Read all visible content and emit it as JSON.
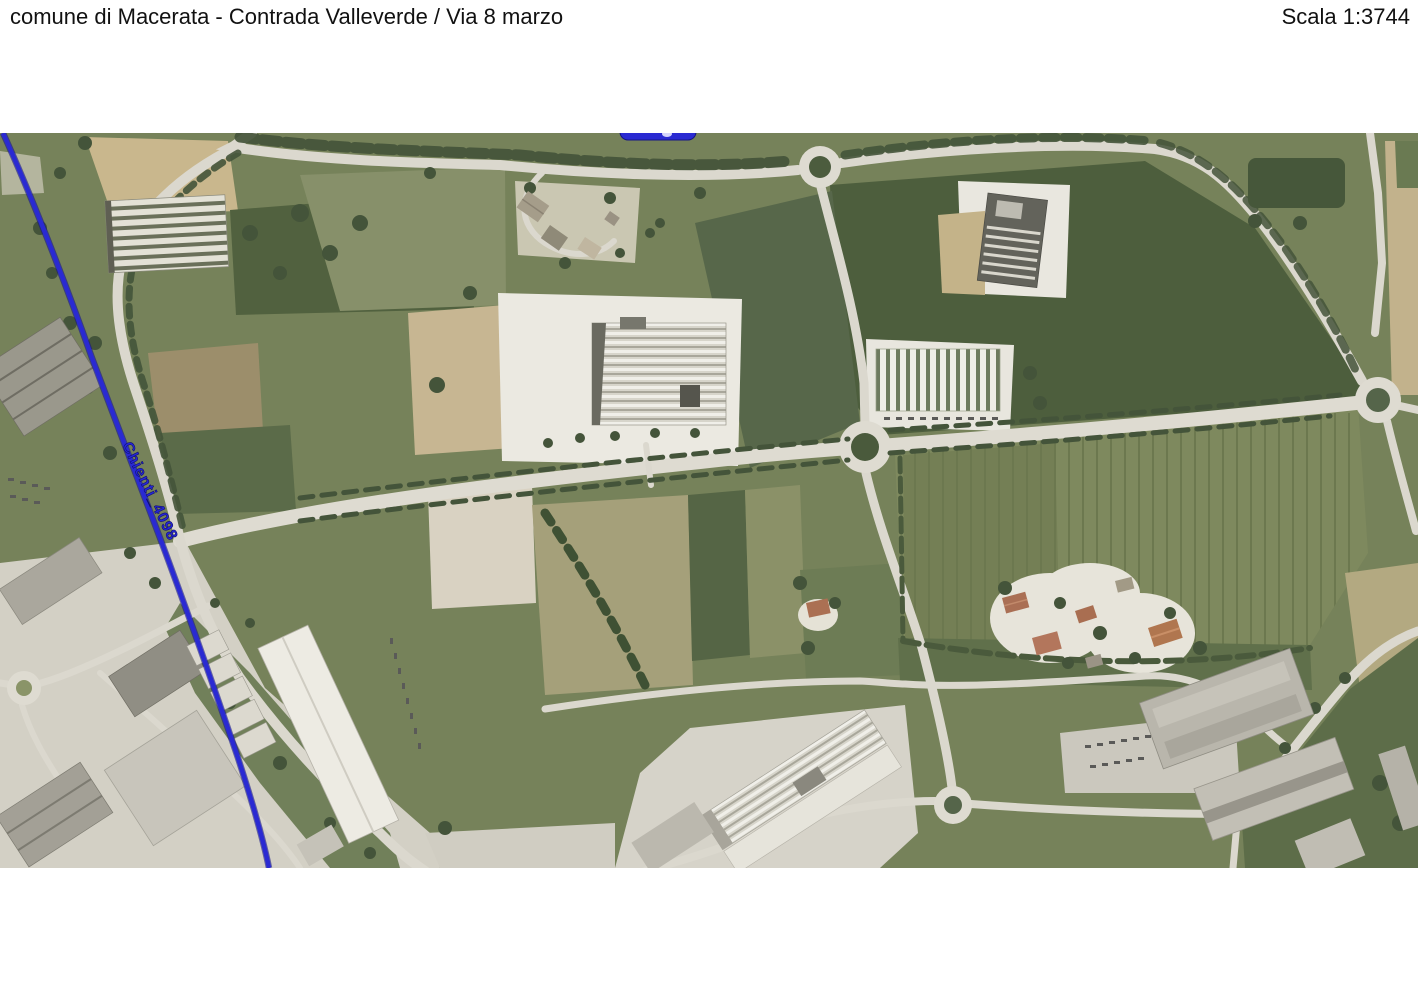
{
  "page": {
    "background": "#ffffff"
  },
  "header": {
    "title": "comune di Macerata - Contrada Valleverde / Via 8 marzo",
    "scale_label": "Scala 1:3744"
  },
  "map": {
    "kind": "aerial-orthophoto",
    "route_overlay": {
      "label": "Chienti_4098",
      "color": "#2a2ad2",
      "casing_color": "#151585"
    },
    "features": {
      "roundabouts": 5
    },
    "palette": {
      "road": "#dbd8ce",
      "field_base_green": "#76825a",
      "field_dark_green": "#4d5e3d",
      "field_olive": "#a5a07a",
      "field_tan": "#c7b692",
      "gravel_white": "#ebe9e1",
      "tree_green": "#44543a",
      "building_gray": "#b9b6ac",
      "building_white": "#edebe3",
      "roof_red": "#ad7254"
    }
  }
}
